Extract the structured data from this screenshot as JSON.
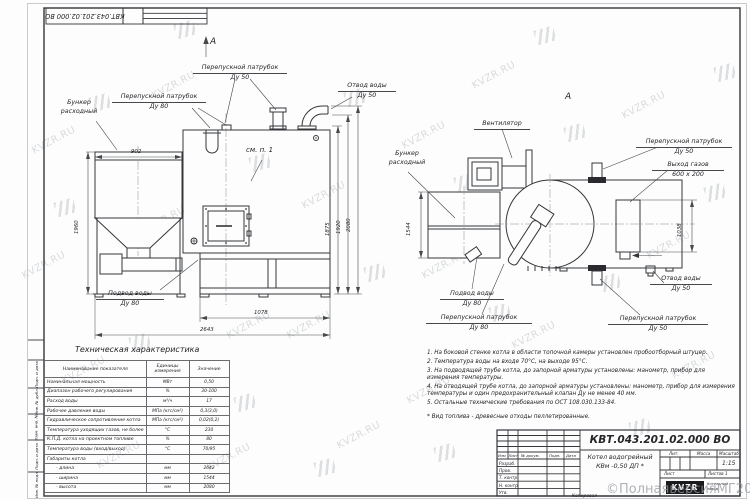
{
  "sheet": {
    "doc_number": "КВТ.043.201.02.000  ВО",
    "doc_number_top": "КВТ.043.201.02.000  ВО",
    "product_title_1": "Котел водогрейный",
    "product_title_2": "КВм -0,50  ДП *",
    "scale_value": "1:15",
    "labels": {
      "lit": "Лит.",
      "mass": "Масса",
      "scale": "Масштаб",
      "sheet": "Лист",
      "sheets": "Листов  1",
      "copied": "Копировал"
    },
    "stamp_cols": [
      "Изм",
      "Лист",
      "№ докум.",
      "Подп.",
      "Дата"
    ],
    "stamp_rows": [
      "Разраб.",
      "Пров.",
      "Т. контр.",
      "Н. контр.",
      "Утв."
    ],
    "logo_text": "KVZR",
    "logo_caption_1": "Котельный",
    "logo_caption_2": "завод",
    "side_labels": [
      "Подп. и дата",
      "Инв. № дубл.",
      "Взам. инв. №",
      "Подп. и дата",
      "Инв. № подл."
    ],
    "watermark_text": "KVZR.RU",
    "watermark_stamp": "©ПолнаяверсияМГ2021"
  },
  "front_view": {
    "view_arrow": "А",
    "see_note": "см. п. 1",
    "labels": {
      "bunker_1": "Бункер",
      "bunker_2": "расходный",
      "bypass80_1": "Перепускной патрубок",
      "bypass80_2": "Ду 80",
      "bypass50_1": "Перепускной патрубок",
      "bypass50_2": "Ду 50",
      "outlet_1": "Отвод воды",
      "outlet_2": "Ду 50",
      "inlet_1": "Подвод воды",
      "inlet_2": "Ду 80"
    },
    "dims": {
      "bunker_w": "902",
      "bunker_h": "1960",
      "base": "1078",
      "length": "2643",
      "h1": "1875",
      "h2": "1920",
      "h3": "2080"
    }
  },
  "top_view": {
    "view_label": "А",
    "labels": {
      "fan": "Вентилятор",
      "bunker_1": "Бункер",
      "bunker_2": "расходный",
      "bypass50t_1": "Перепускной патрубок",
      "bypass50t_2": "Ду 50",
      "gas_1": "Выход газов",
      "gas_2": "600 x 200",
      "outlet_1": "Отвод воды",
      "outlet_2": "Ду 50",
      "inlet_1": "Подвод воды",
      "inlet_2": "Ду 80",
      "bypass80_1": "Перепускной патрубок",
      "bypass80_2": "Ду 80",
      "bypass50b_1": "Перепускной патрубок",
      "bypass50b_2": "Ду 50"
    },
    "dims": {
      "width": "1544",
      "gas": "1038"
    }
  },
  "spec_table": {
    "title": "Техническая характеристика",
    "col_name": "Наименование показателя",
    "col_unit_1": "Единицы",
    "col_unit_2": "измерения",
    "col_value": "Значение",
    "rows": [
      {
        "n": "Номинальная мощность",
        "u": "МВт",
        "v": "0,50"
      },
      {
        "n": "Диапазон рабочего регулирования",
        "u": "%",
        "v": "30-100"
      },
      {
        "n": "Расход воды",
        "u": "м³/ч",
        "v": "17"
      },
      {
        "n": "Рабочее давление воды",
        "u": "МПа (кгс/см²)",
        "v": "0,3(3,0)"
      },
      {
        "n": "Гидравлическое сопротивление котла",
        "u": "МПа (кгс/см²)",
        "v": "0,02(0,2)"
      },
      {
        "n": "Температура уходящих газов, не более",
        "u": "°С",
        "v": "230"
      },
      {
        "n": "К.П.Д. котла на проектном топливе",
        "u": "%",
        "v": "80"
      },
      {
        "n": "Температура воды (вход/выход)",
        "u": "°С",
        "v": "70/95"
      },
      {
        "n": "Габариты котла",
        "u": "",
        "v": ""
      },
      {
        "n": "- длина",
        "u": "мм",
        "v": "2642"
      },
      {
        "n": "- ширина",
        "u": "мм",
        "v": "1544"
      },
      {
        "n": "- высота",
        "u": "мм",
        "v": "2080"
      }
    ]
  },
  "notes": [
    "1.  На боковой стенке котла в области топочной камеры установлен пробоотборный штуцер.",
    "2.  Температура воды на входе 70°С, на выходе 95°С.",
    "3.  На подводящей трубе котла, до запорной арматуры установлены: манометр, прибор для измерения температуры.",
    "4.  На отводящей трубе котла, до запорной арматуры установлены: манометр, прибор для измерения температуры и один предохранительный клапан Ду не менее 40 мм.",
    "5.  Остальные технические требования по ОСТ 108.030.133-84."
  ],
  "fuel_note": "*  Вид топлива - древесные отходы пеллетированные."
}
